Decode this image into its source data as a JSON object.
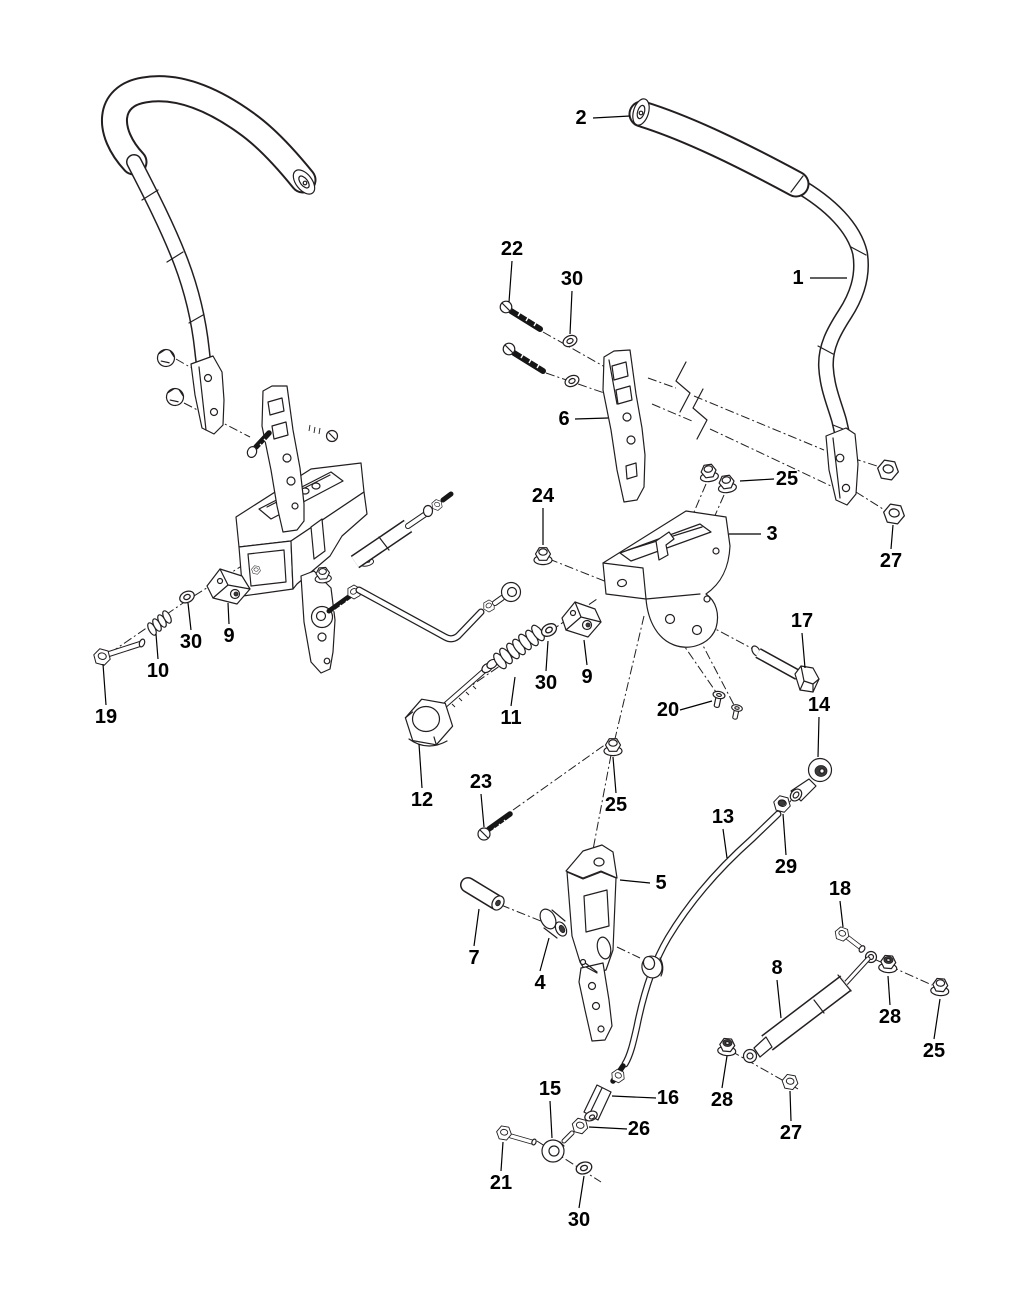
{
  "figure": {
    "type": "exploded-parts-diagram",
    "width": 1024,
    "height": 1316,
    "background": "#ffffff",
    "ink_color": "#231f20",
    "label_color": "#000000",
    "label_font_size": 20
  },
  "callouts": [
    {
      "part": "2",
      "label": [
        581,
        118
      ],
      "leader": [
        [
          593,
          118
        ],
        [
          630,
          116
        ]
      ]
    },
    {
      "part": "1",
      "label": [
        798,
        278
      ],
      "leader": [
        [
          810,
          278
        ],
        [
          847,
          278
        ]
      ]
    },
    {
      "part": "22",
      "label": [
        512,
        249
      ],
      "leader": [
        [
          512,
          261
        ],
        [
          509,
          302
        ]
      ]
    },
    {
      "part": "30",
      "label": [
        572,
        279
      ],
      "leader": [
        [
          572,
          291
        ],
        [
          570,
          334
        ]
      ]
    },
    {
      "part": "6",
      "label": [
        564,
        419
      ],
      "leader": [
        [
          575,
          419
        ],
        [
          608,
          418
        ]
      ]
    },
    {
      "part": "25",
      "label": [
        787,
        479
      ],
      "leader": [
        [
          774,
          479
        ],
        [
          740,
          481
        ]
      ]
    },
    {
      "part": "3",
      "label": [
        772,
        534
      ],
      "leader": [
        [
          761,
          534
        ],
        [
          729,
          534
        ]
      ]
    },
    {
      "part": "27",
      "label": [
        891,
        561
      ],
      "leader": [
        [
          891,
          549
        ],
        [
          893,
          525
        ]
      ]
    },
    {
      "part": "24",
      "label": [
        543,
        496
      ],
      "leader": [
        [
          543,
          508
        ],
        [
          543,
          545
        ]
      ]
    },
    {
      "part": "17",
      "label": [
        802,
        621
      ],
      "leader": [
        [
          802,
          633
        ],
        [
          805,
          668
        ]
      ]
    },
    {
      "part": "30",
      "label": [
        191,
        642
      ],
      "leader": [
        [
          191,
          630
        ],
        [
          188,
          603
        ]
      ]
    },
    {
      "part": "9",
      "label": [
        229,
        636
      ],
      "leader": [
        [
          229,
          624
        ],
        [
          228,
          603
        ]
      ]
    },
    {
      "part": "10",
      "label": [
        158,
        671
      ],
      "leader": [
        [
          158,
          659
        ],
        [
          156,
          634
        ]
      ]
    },
    {
      "part": "19",
      "label": [
        106,
        717
      ],
      "leader": [
        [
          106,
          705
        ],
        [
          103,
          664
        ]
      ]
    },
    {
      "part": "12",
      "label": [
        422,
        800
      ],
      "leader": [
        [
          422,
          788
        ],
        [
          419,
          744
        ]
      ]
    },
    {
      "part": "11",
      "label": [
        511,
        718
      ],
      "leader": [
        [
          511,
          706
        ],
        [
          515,
          677
        ]
      ]
    },
    {
      "part": "30",
      "label": [
        546,
        683
      ],
      "leader": [
        [
          546,
          671
        ],
        [
          548,
          641
        ]
      ]
    },
    {
      "part": "9",
      "label": [
        587,
        677
      ],
      "leader": [
        [
          587,
          665
        ],
        [
          584,
          640
        ]
      ]
    },
    {
      "part": "20",
      "label": [
        668,
        710
      ],
      "leader": [
        [
          680,
          710
        ],
        [
          712,
          701
        ]
      ]
    },
    {
      "part": "14",
      "label": [
        819,
        705
      ],
      "leader": [
        [
          819,
          717
        ],
        [
          818,
          757
        ]
      ]
    },
    {
      "part": "25",
      "label": [
        616,
        805
      ],
      "leader": [
        [
          616,
          793
        ],
        [
          613,
          757
        ]
      ]
    },
    {
      "part": "23",
      "label": [
        481,
        782
      ],
      "leader": [
        [
          481,
          794
        ],
        [
          484,
          827
        ]
      ]
    },
    {
      "part": "29",
      "label": [
        786,
        867
      ],
      "leader": [
        [
          786,
          855
        ],
        [
          783,
          814
        ]
      ]
    },
    {
      "part": "13",
      "label": [
        723,
        817
      ],
      "leader": [
        [
          723,
          829
        ],
        [
          727,
          858
        ]
      ]
    },
    {
      "part": "5",
      "label": [
        661,
        883
      ],
      "leader": [
        [
          650,
          883
        ],
        [
          620,
          880
        ]
      ]
    },
    {
      "part": "7",
      "label": [
        474,
        958
      ],
      "leader": [
        [
          474,
          946
        ],
        [
          479,
          909
        ]
      ]
    },
    {
      "part": "4",
      "label": [
        540,
        983
      ],
      "leader": [
        [
          540,
          971
        ],
        [
          549,
          938
        ]
      ]
    },
    {
      "part": "18",
      "label": [
        840,
        889
      ],
      "leader": [
        [
          840,
          901
        ],
        [
          843,
          927
        ]
      ]
    },
    {
      "part": "8",
      "label": [
        777,
        968
      ],
      "leader": [
        [
          777,
          980
        ],
        [
          781,
          1018
        ]
      ]
    },
    {
      "part": "28",
      "label": [
        890,
        1017
      ],
      "leader": [
        [
          890,
          1005
        ],
        [
          888,
          976
        ]
      ]
    },
    {
      "part": "25",
      "label": [
        934,
        1051
      ],
      "leader": [
        [
          934,
          1039
        ],
        [
          940,
          999
        ]
      ]
    },
    {
      "part": "28",
      "label": [
        722,
        1100
      ],
      "leader": [
        [
          722,
          1088
        ],
        [
          727,
          1056
        ]
      ]
    },
    {
      "part": "27",
      "label": [
        791,
        1133
      ],
      "leader": [
        [
          791,
          1121
        ],
        [
          790,
          1091
        ]
      ]
    },
    {
      "part": "16",
      "label": [
        668,
        1098
      ],
      "leader": [
        [
          656,
          1098
        ],
        [
          612,
          1096
        ]
      ]
    },
    {
      "part": "26",
      "label": [
        639,
        1129
      ],
      "leader": [
        [
          627,
          1129
        ],
        [
          589,
          1127
        ]
      ]
    },
    {
      "part": "15",
      "label": [
        550,
        1089
      ],
      "leader": [
        [
          550,
          1101
        ],
        [
          552,
          1138
        ]
      ]
    },
    {
      "part": "21",
      "label": [
        501,
        1183
      ],
      "leader": [
        [
          501,
          1171
        ],
        [
          503,
          1142
        ]
      ]
    },
    {
      "part": "30",
      "label": [
        579,
        1220
      ],
      "leader": [
        [
          579,
          1208
        ],
        [
          584,
          1176
        ]
      ]
    }
  ]
}
